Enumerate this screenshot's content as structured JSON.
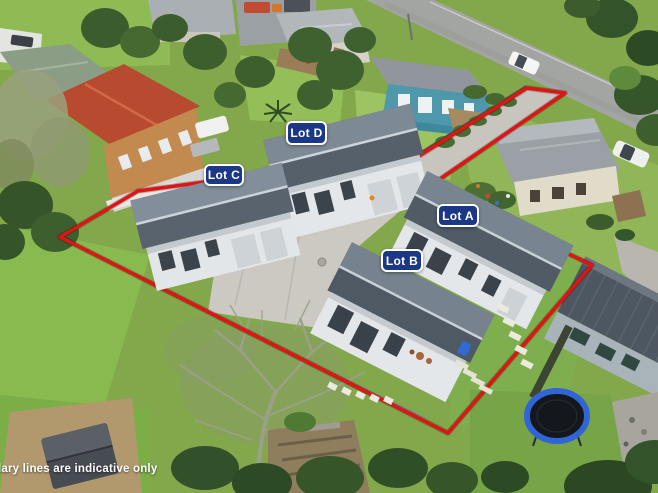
{
  "photo": {
    "type": "aerial-drone-photo-of-townhouse-development",
    "disclaimer": "Boundary lines are indicative only"
  },
  "lots": [
    {
      "label": "Lot A"
    },
    {
      "label": "Lot B"
    },
    {
      "label": "Lot C"
    },
    {
      "label": "Lot D"
    }
  ],
  "colors": {
    "boundary_red": "#e21313",
    "lot_badge_bg": "#1c3786",
    "lot_badge_border": "#ffffff",
    "lot_badge_text": "#ffffff",
    "townhouse_roof": "#55606b",
    "townhouse_wall": "#e4e7e9",
    "grass": "#83a84c",
    "driveway_concrete": "#c7c5bd",
    "road_asphalt": "#a3a5a3",
    "red_roof_neighbor": "#b84a2f",
    "teal_house": "#4f98ac",
    "trampoline_blue": "#3165d6"
  }
}
